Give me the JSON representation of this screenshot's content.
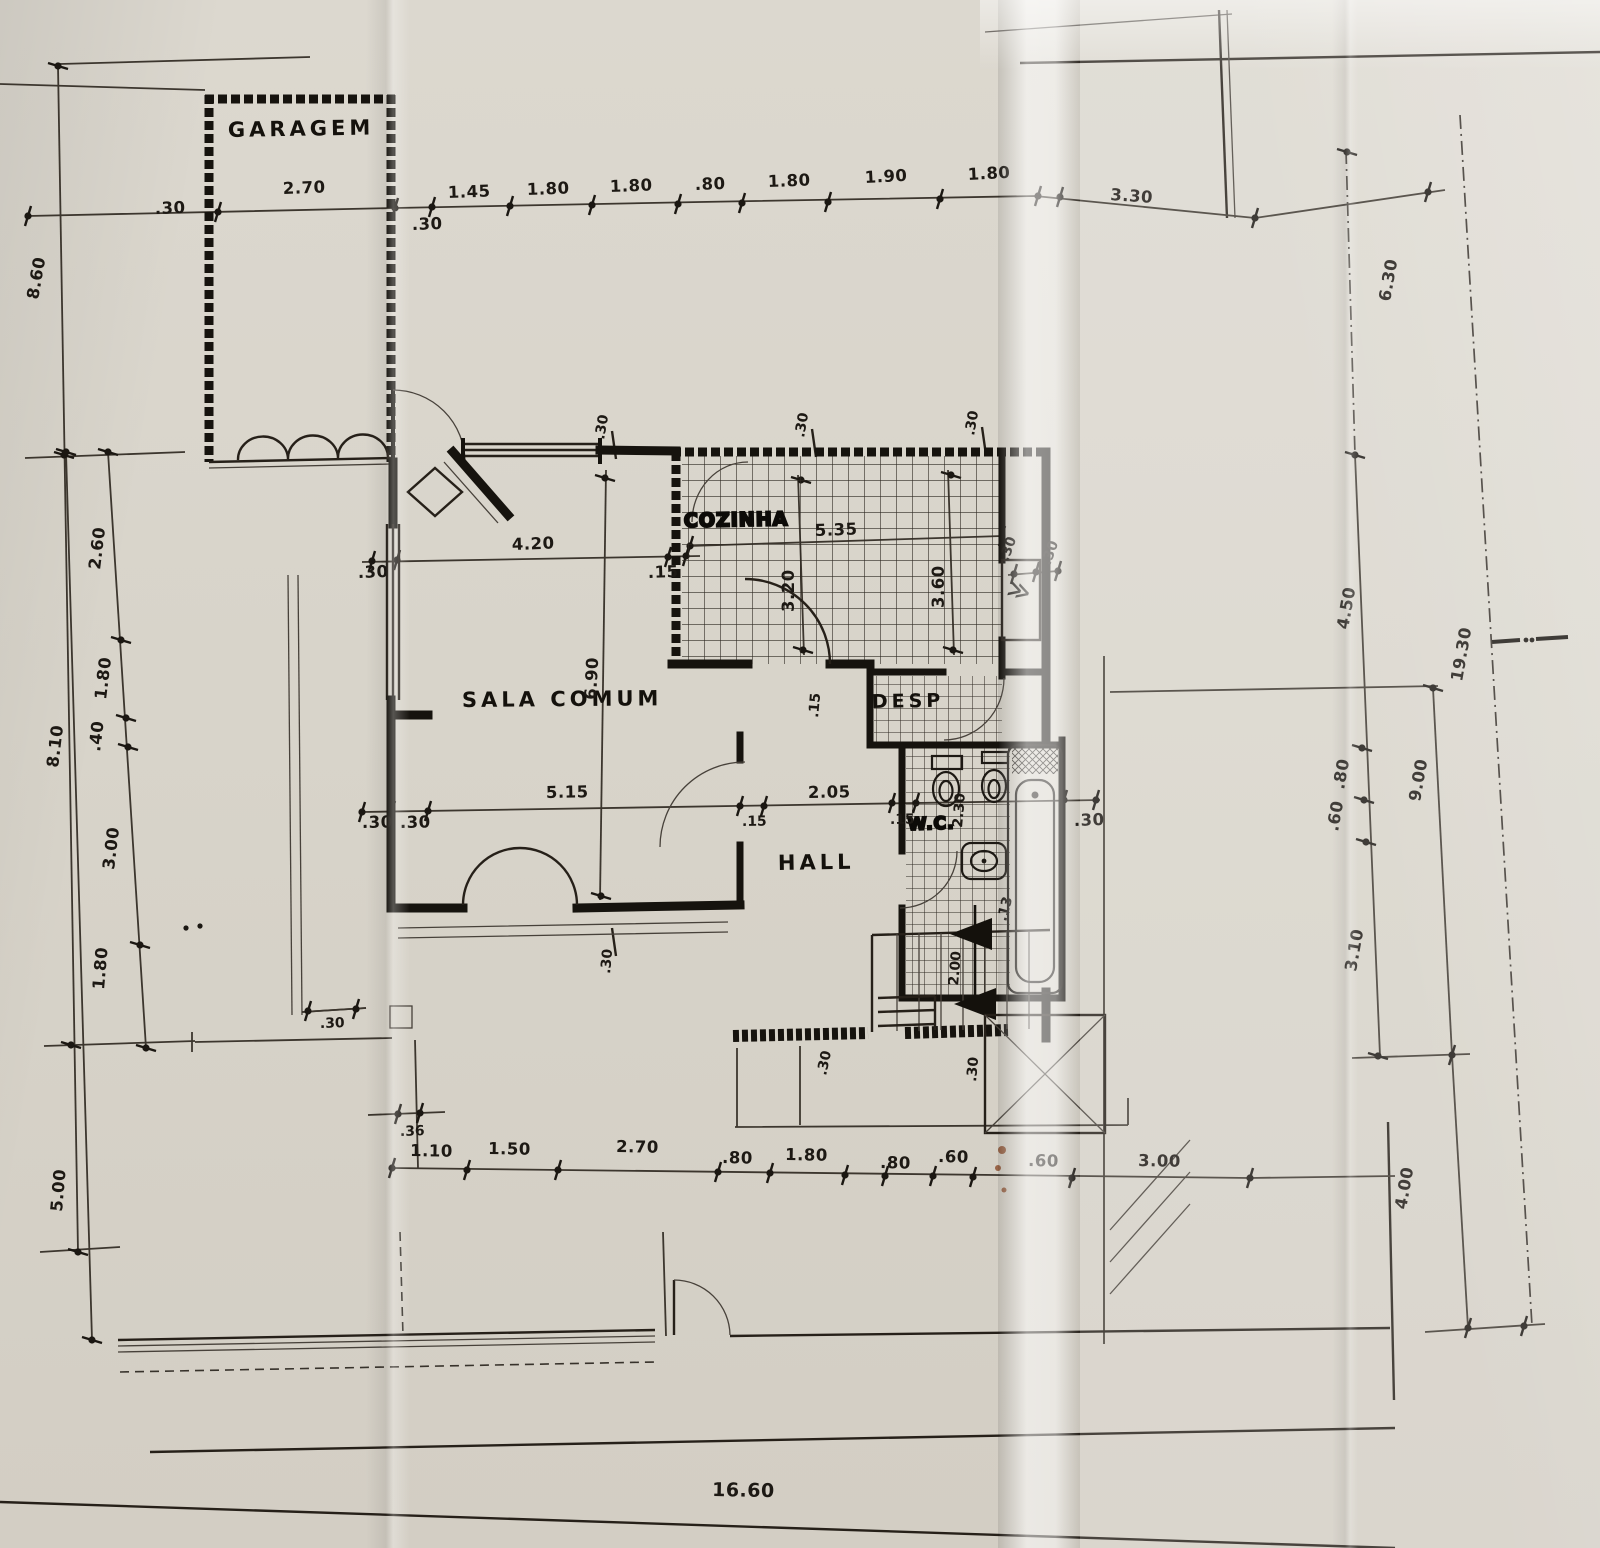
{
  "rooms": {
    "garagem": "GARAGEM",
    "sala_comum": "SALA COMUM",
    "cozinha": "COZINHA",
    "desp": "DESP",
    "hall": "HALL",
    "wc": "W.C."
  },
  "icons": {
    "double_chevron": "≫"
  },
  "dims": {
    "top": [
      "2.70",
      ".30",
      ".30",
      "1.45",
      "1.80",
      "1.80",
      ".80",
      "1.80",
      "1.90",
      "1.80",
      "3.30"
    ],
    "left": [
      "8.60",
      "8.10",
      "5.00",
      "2.60",
      "1.80",
      ".40",
      "3.00",
      "1.80"
    ],
    "right": [
      "6.30",
      "4.50",
      "19.30",
      ".80",
      ".60",
      "9.00",
      "3.10",
      "4.00"
    ],
    "bottom": [
      ".36",
      "1.10",
      "1.50",
      "2.70",
      ".80",
      "1.80",
      ".80",
      ".60",
      ".60",
      "3.00",
      "16.60"
    ],
    "interior": [
      "4.20",
      ".30",
      ".15",
      "6.90",
      "5.35",
      "3.20",
      "3.60",
      ".30",
      ".30",
      ".30",
      ".30",
      ".30",
      "5.15",
      ".30",
      ".30",
      "2.05",
      ".15",
      ".15",
      "2.30",
      ".30",
      ".13",
      "2.00",
      ".30",
      ".30",
      ".30",
      ".15",
      ".30"
    ]
  }
}
